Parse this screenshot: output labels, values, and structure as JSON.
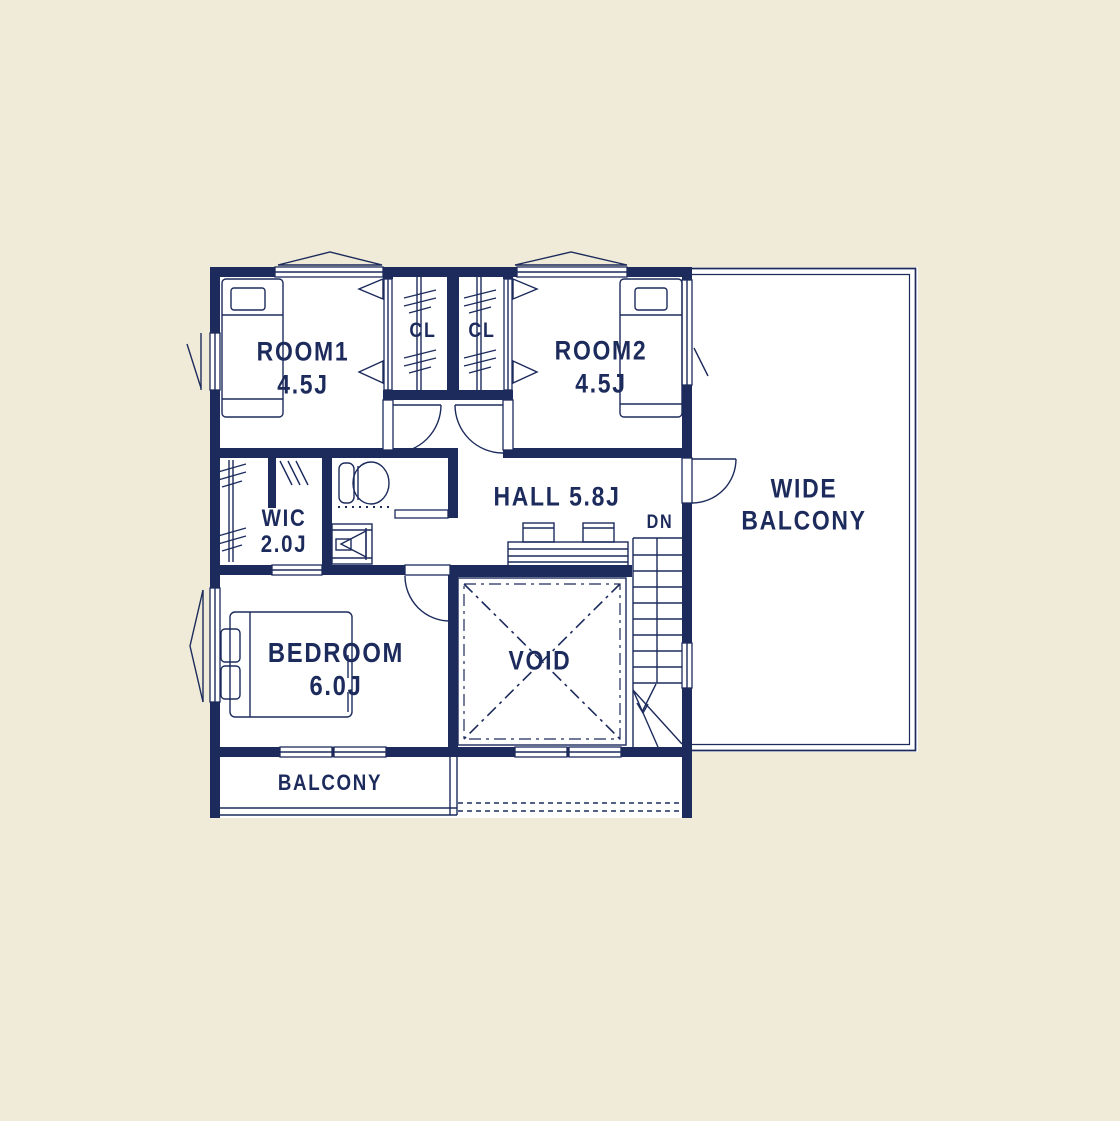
{
  "colors": {
    "ink": "#1c2b5c",
    "background": "#f0ebd8",
    "floor": "#ffffff"
  },
  "labels": {
    "room1_name": "ROOM1",
    "room1_size": "4.5J",
    "closet1": "CL",
    "closet2": "CL",
    "room2_name": "ROOM2",
    "room2_size": "4.5J",
    "wic_name": "WIC",
    "wic_size": "2.0J",
    "hall": "HALL 5.8J",
    "stairs_direction": "DN",
    "wide_balcony_line1": "WIDE",
    "wide_balcony_line2": "BALCONY",
    "void": "VOID",
    "bedroom_name": "BEDROOM",
    "bedroom_size": "6.0J",
    "balcony": "BALCONY"
  },
  "icons": [
    "bed-icon-room1",
    "bed-icon-room2",
    "bed-icon-bedroom",
    "toilet-icon",
    "washbasin-icon",
    "hanger-rod-icon",
    "stairs-icon",
    "door-arc-icon",
    "window-icon",
    "void-cross-icon"
  ]
}
